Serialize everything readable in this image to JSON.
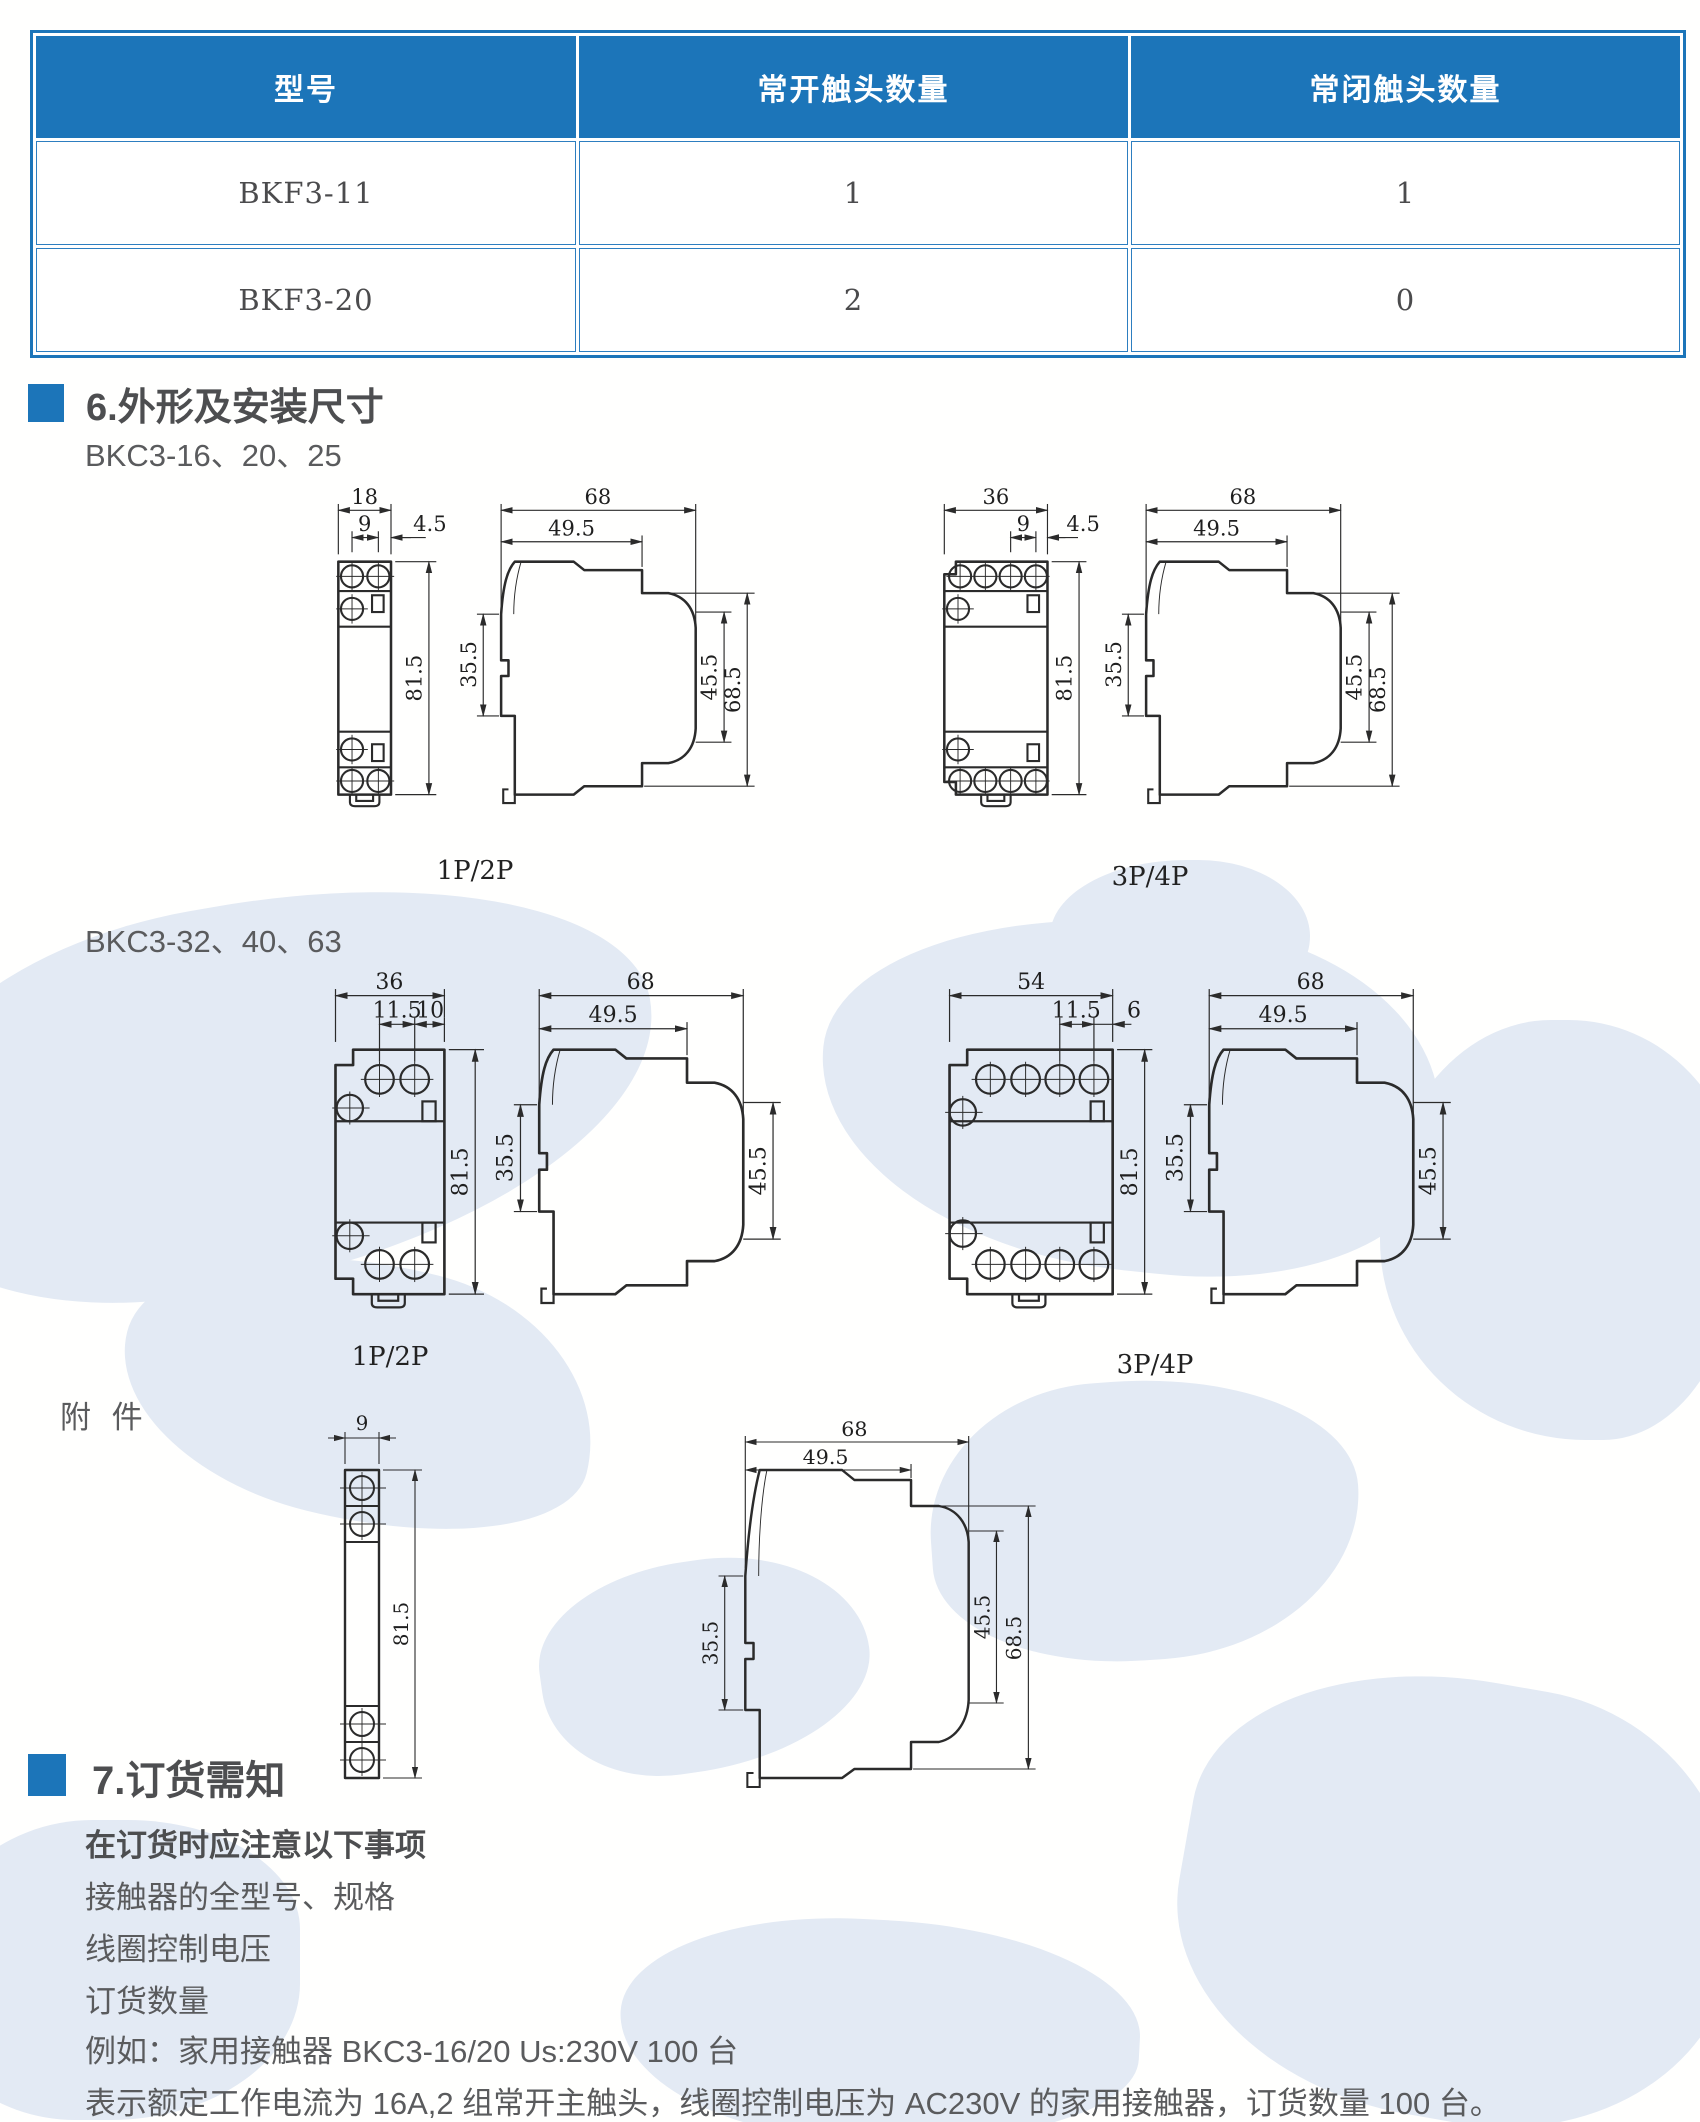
{
  "table": {
    "headers": [
      "型号",
      "常开触头数量",
      "常闭触头数量"
    ],
    "rows": [
      [
        "BKF3-11",
        "1",
        "1"
      ],
      [
        "BKF3-20",
        "2",
        "0"
      ]
    ]
  },
  "section6": {
    "title": "6.外形及安装尺寸",
    "series_a": "BKC3-16、20、25",
    "series_b": "BKC3-32、40、63",
    "accessory_label": "附 件",
    "pole_1p2p": "1P/2P",
    "pole_3p4p": "3P/4P"
  },
  "dims": {
    "r1f1": {
      "w": "18",
      "pitch": "9",
      "edge": "4.5",
      "h": "81.5"
    },
    "r1f2": {
      "w": "36",
      "pitch": "9",
      "edge": "4.5",
      "h": "81.5"
    },
    "r2f1": {
      "w": "36",
      "pitch": "11.5",
      "edge": "10",
      "h": "81.5"
    },
    "r2f2": {
      "w": "54",
      "pitch": "11.5",
      "edge": "6",
      "h": "81.5"
    },
    "side": {
      "depth": "68",
      "front_depth": "49.5",
      "rail": "35.5",
      "face": "45.5",
      "total": "68.5"
    },
    "strip": {
      "w": "9",
      "h": "81.5"
    }
  },
  "section7": {
    "title": "7.订货需知",
    "note_title": "在订货时应注意以下事项",
    "items": [
      "接触器的全型号、规格",
      "线圈控制电压",
      "订货数量"
    ],
    "example": "例如：家用接触器 BKC3-16/20  Us:230V  100 台",
    "explanation": "表示额定工作电流为 16A,2 组常开主触头，线圈控制电压为 AC230V 的家用接触器，订货数量 100 台。"
  },
  "colors": {
    "accent": "#1c75b9",
    "heading": "#4d4e50",
    "body": "#5a5b5d",
    "line": "#2b2b2b",
    "map": "#e3eaf4"
  }
}
